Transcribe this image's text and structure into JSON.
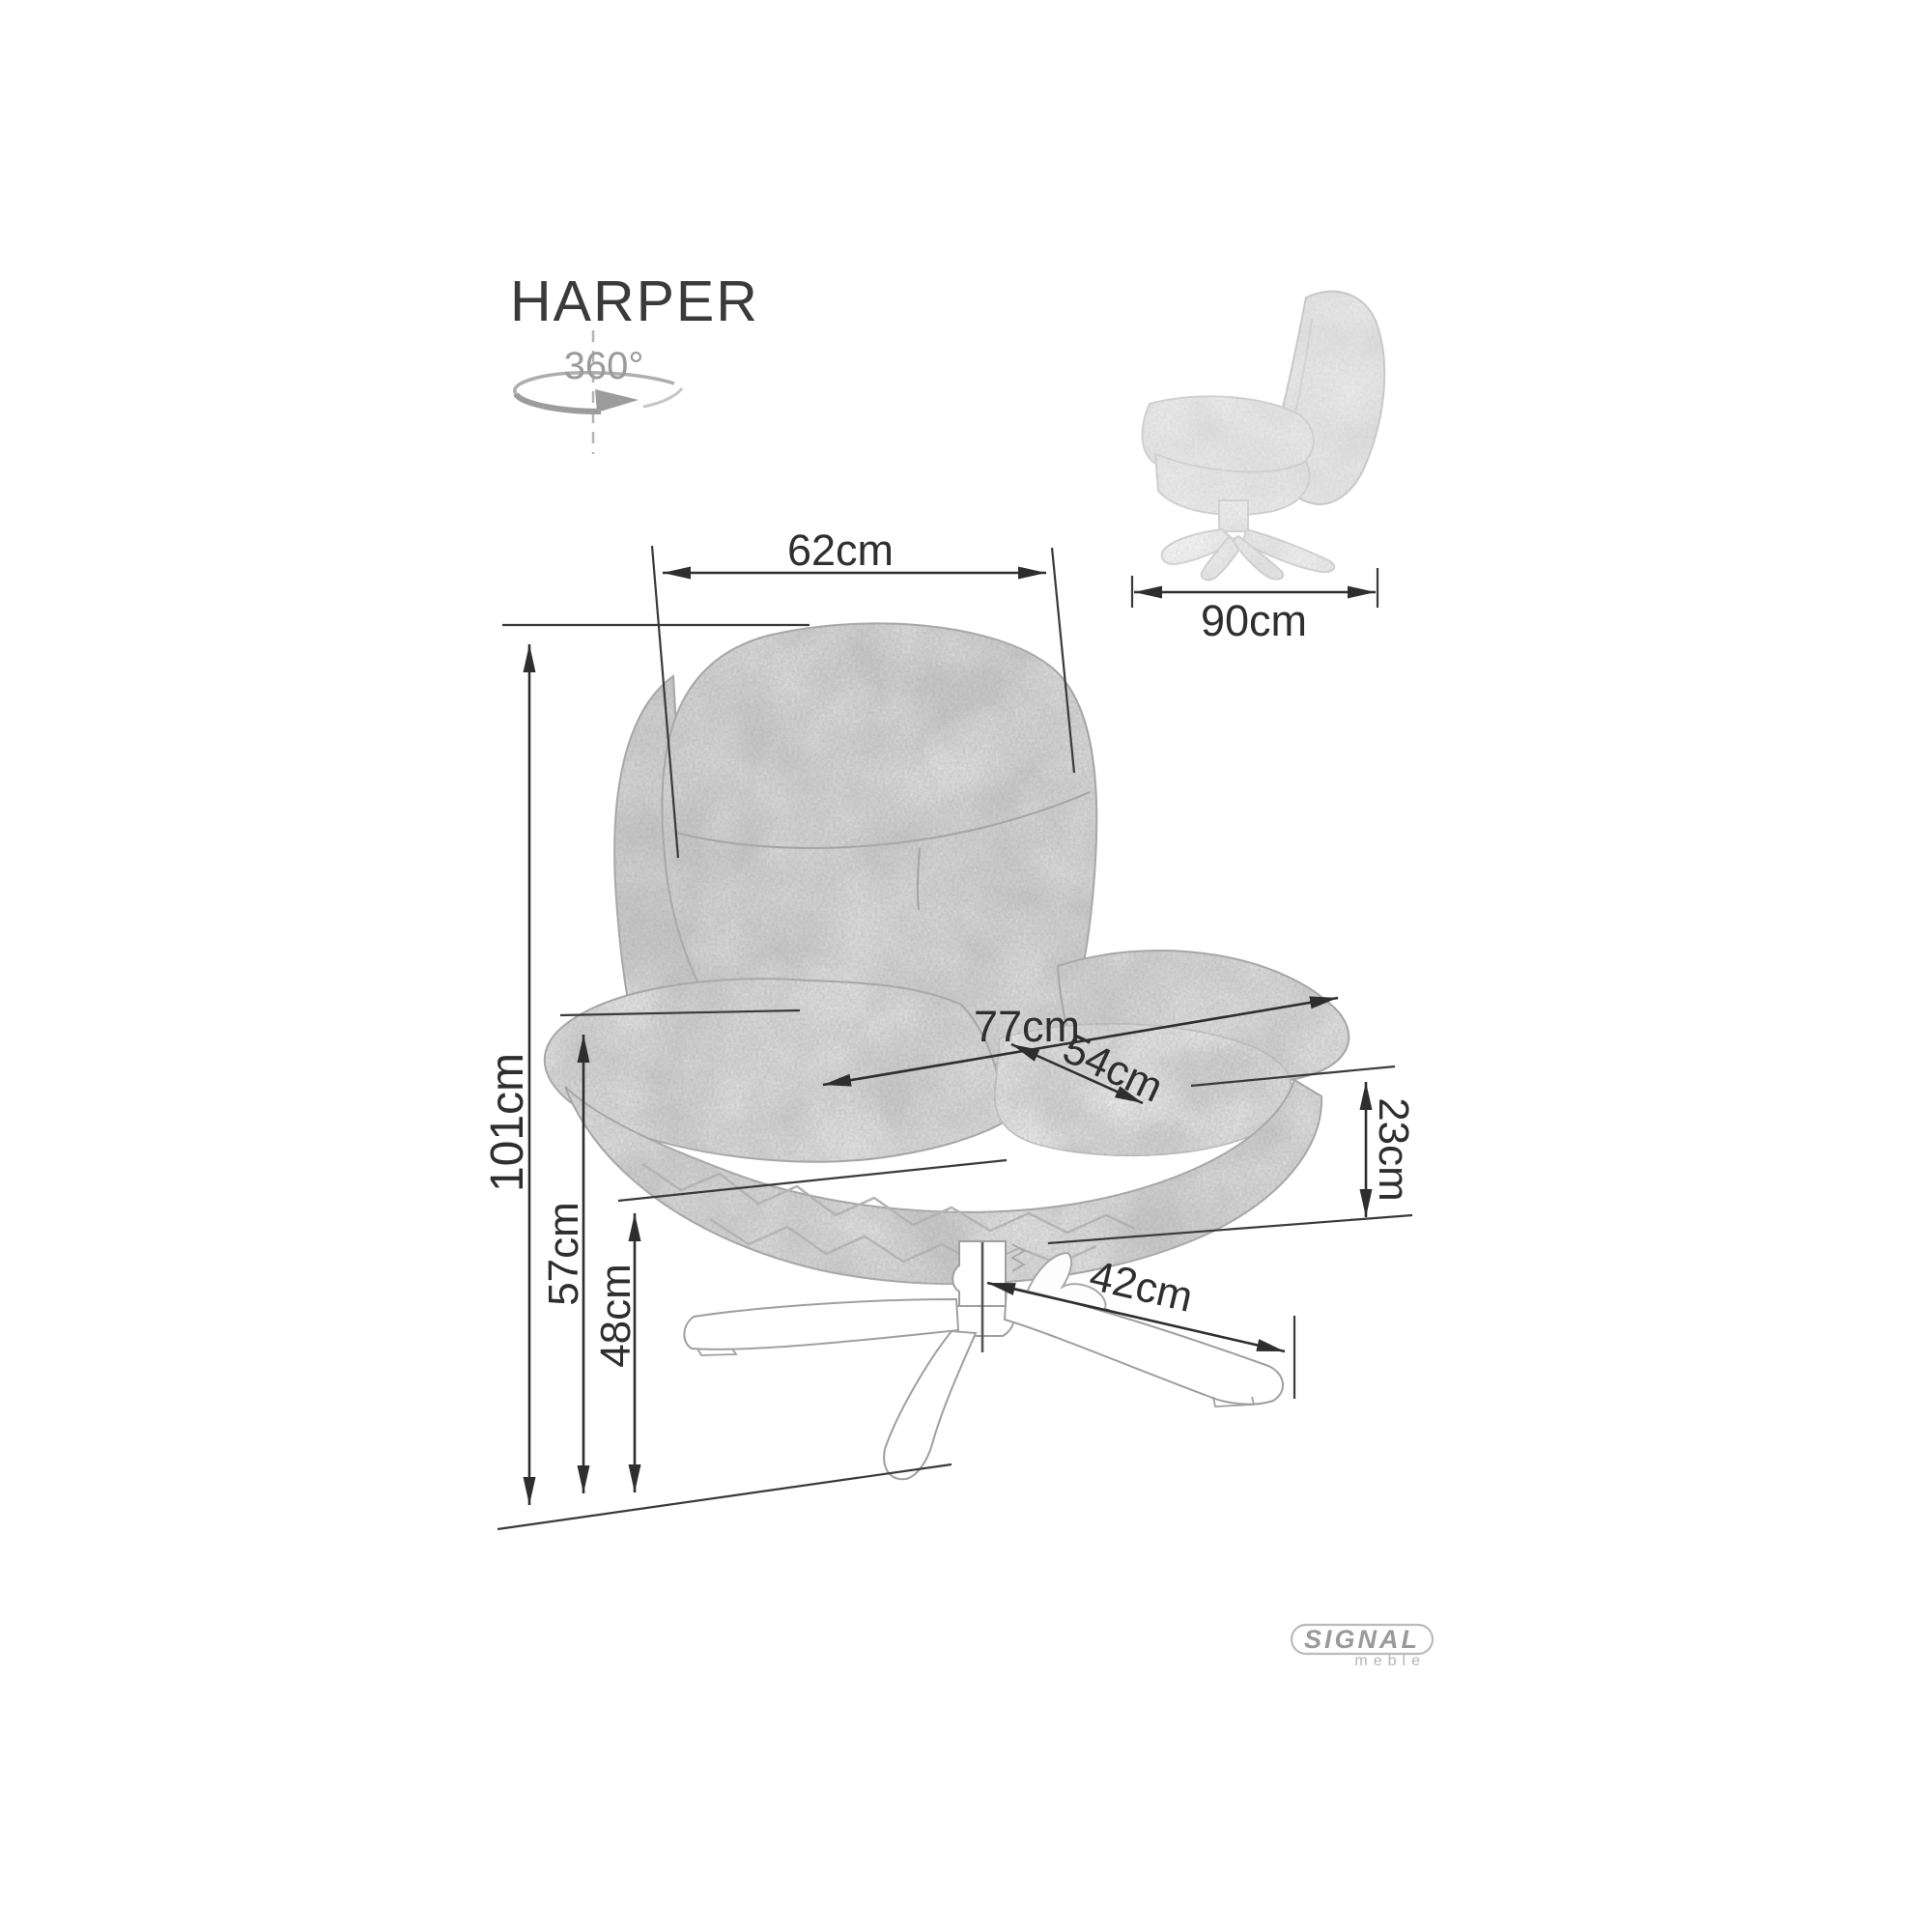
{
  "header": {
    "title": "HARPER"
  },
  "rotation_badge": {
    "label": "360°",
    "color": "#9b9b9b"
  },
  "side_view": {
    "depth_label": "90cm"
  },
  "front_view": {
    "back_width_label": "62cm",
    "total_height_label": "101cm",
    "total_width_label": "77cm",
    "seat_width_label": "54cm",
    "armrest_height_label": "57cm",
    "seat_height_label": "48cm",
    "seat_thickness_label": "23cm",
    "base_leg_label": "42cm"
  },
  "logo": {
    "brand": "SIGNAL",
    "subtext": "meble"
  },
  "colors": {
    "dimension_lines": "#2e2e2e",
    "chair_outline": "#a6a6a6",
    "texture_gray": "#b5b5b5",
    "rotation_gray": "#9b9b9b",
    "logo_gray": "#9a9a9a",
    "background": "#ffffff"
  }
}
